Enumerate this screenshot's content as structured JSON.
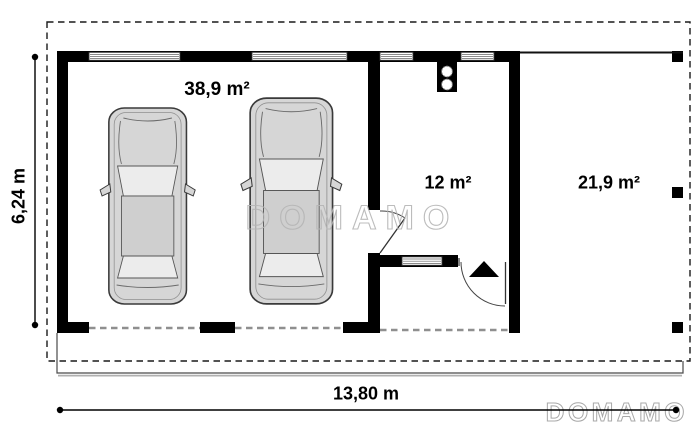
{
  "plan": {
    "watermark_text": "DOMAMO",
    "rooms": {
      "garage": {
        "label": "38,9 m²"
      },
      "storage": {
        "label": "12 m²"
      },
      "carport": {
        "label": "21,9 m²"
      }
    },
    "dimensions": {
      "width": {
        "label": "13,80 m"
      },
      "depth": {
        "label": "6,24 m"
      }
    },
    "colors": {
      "wall": "#000000",
      "roof_outline": "#1a1a1a",
      "opening_dash": "#8f8f8f",
      "apron_line": "#4a4a4a",
      "car_body": "#d6d6d6",
      "car_glass": "#ececec",
      "car_roof": "#cfcfcf",
      "watermark": "#b5b5b5"
    }
  }
}
